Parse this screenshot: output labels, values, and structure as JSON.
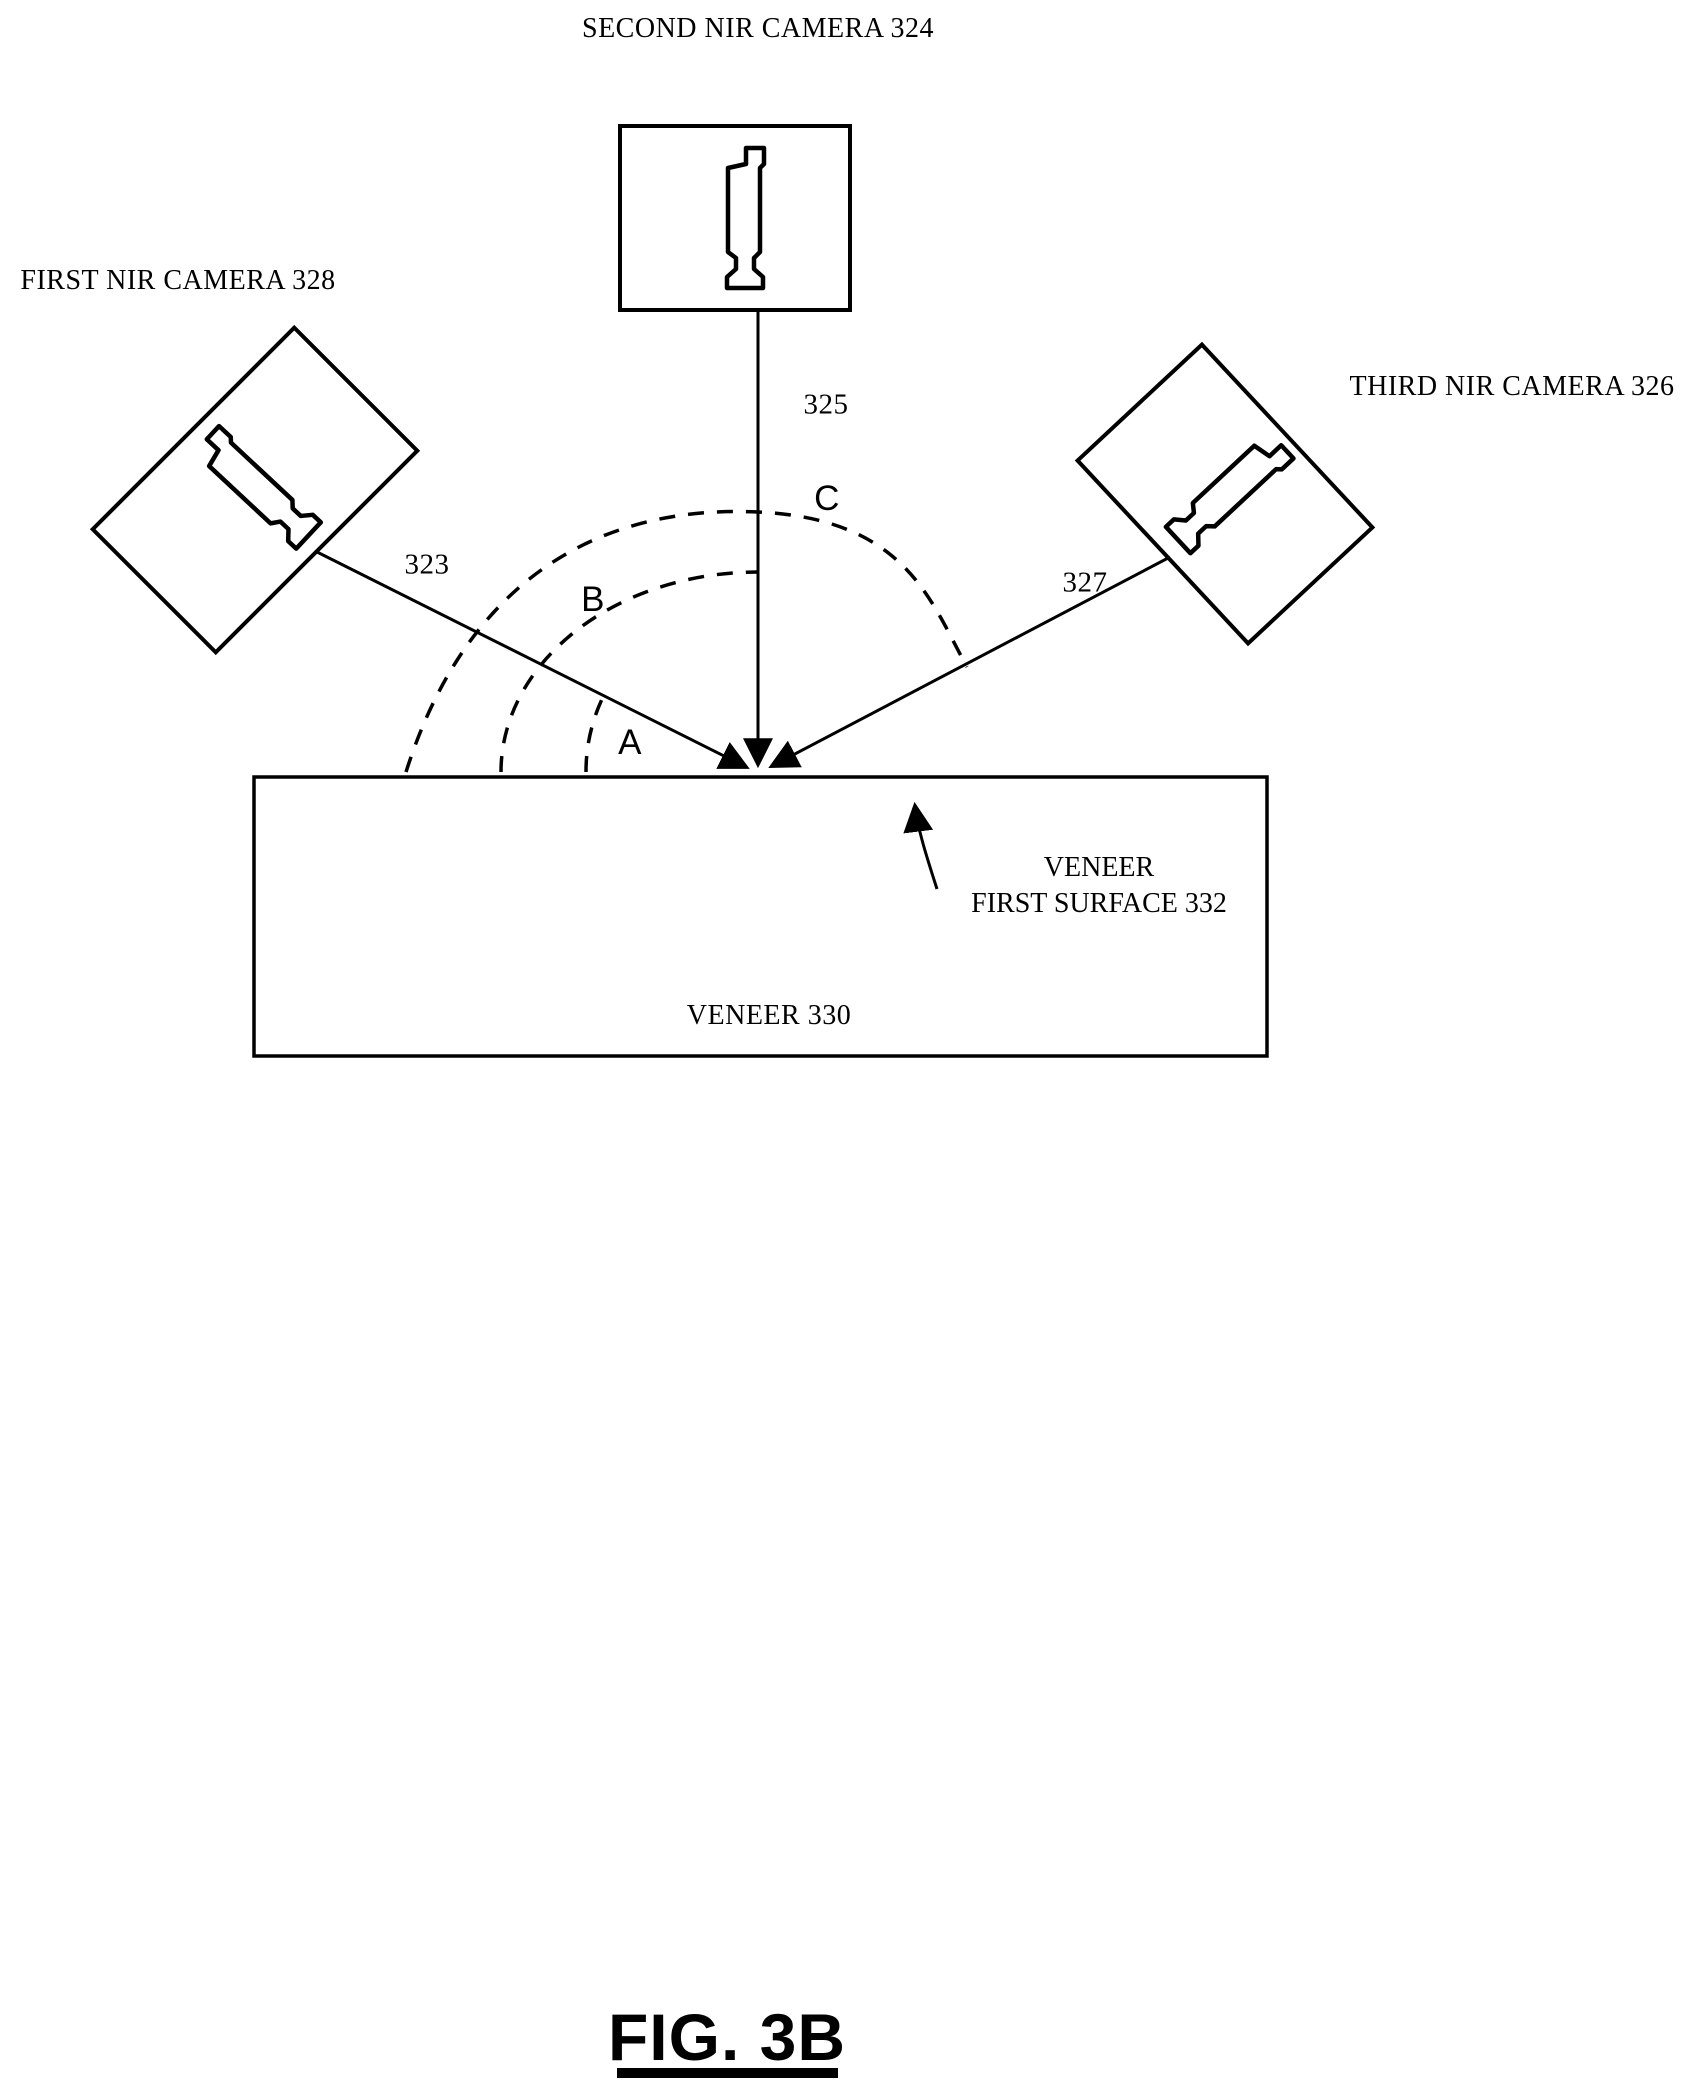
{
  "colors": {
    "ink": "#000000",
    "paper": "#ffffff"
  },
  "cameras": {
    "second": {
      "label": "SECOND NIR CAMERA 324",
      "ray_label": "325"
    },
    "first": {
      "label": "FIRST NIR CAMERA 328",
      "ray_label": "323"
    },
    "third": {
      "label": "THIRD NIR CAMERA 326",
      "ray_label": "327"
    }
  },
  "angles": {
    "a": "A",
    "b": "B",
    "c": "C"
  },
  "veneer": {
    "body_label": "VENEER 330",
    "surface_label_line1": "VENEER",
    "surface_label_line2": "FIRST SURFACE 332"
  },
  "figure": {
    "caption": "FIG. 3B"
  }
}
